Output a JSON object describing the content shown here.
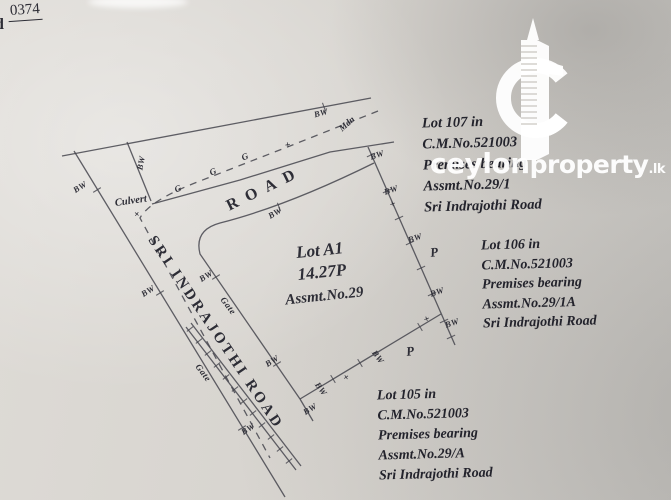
{
  "page": {
    "corner_fragment_top": "0374",
    "corner_fragment_side": "d"
  },
  "watermark": {
    "brand_bold": "ceylon",
    "brand_regular": "property",
    "brand_tld": ".lk",
    "color": "#ffffff"
  },
  "colors": {
    "paper": "#d5d2cd",
    "ink": "#45454d",
    "text": "#23232c"
  },
  "survey": {
    "main_lot": {
      "name": "Lot A1",
      "area": "14.27P",
      "assessment": "Assmt.No.29"
    },
    "roads": {
      "top_road": "ROAD",
      "left_road": "SRI INDRAJOTHI ROAD"
    },
    "labels": {
      "bw": "BW",
      "gate": "Gate",
      "culvert": "Culvert",
      "mdn": "Mdn",
      "g": "G",
      "p": "P",
      "plus": "+"
    },
    "adjacent_lots": [
      {
        "id": "lot-107",
        "lines": [
          "Lot 107 in",
          "C.M.No.521003",
          "Premises bearing",
          "Assmt.No.29/1",
          "Sri Indrajothi Road"
        ]
      },
      {
        "id": "lot-106",
        "lines": [
          "Lot 106 in",
          "C.M.No.521003",
          "Premises bearing",
          "Assmt.No.29/1A",
          "Sri Indrajothi Road"
        ]
      },
      {
        "id": "lot-105",
        "lines": [
          "Lot 105 in",
          "C.M.No.521003",
          "Premises bearing",
          "Assmt.No.29/A",
          "Sri Indrajothi Road"
        ]
      }
    ]
  }
}
